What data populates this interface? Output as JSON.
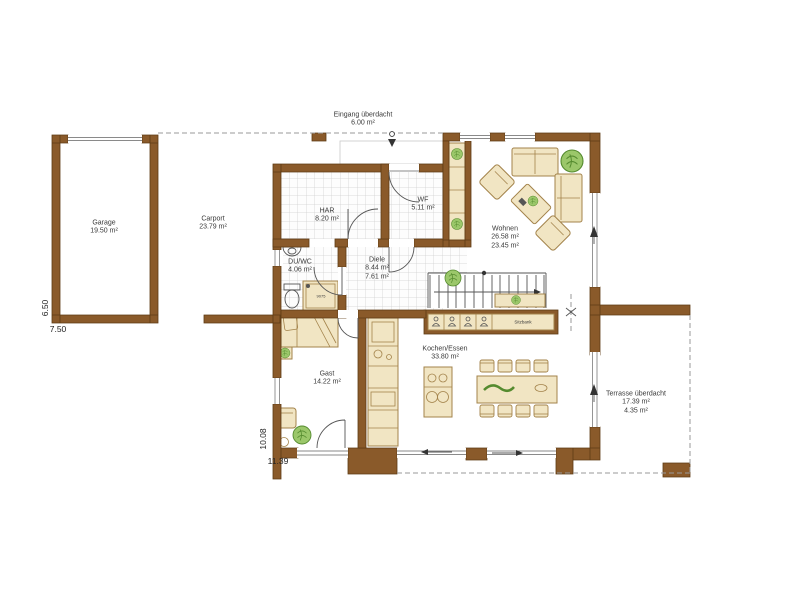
{
  "rooms": {
    "eingang": {
      "name": "Eingang überdacht",
      "area": "6.00 m²"
    },
    "garage": {
      "name": "Garage",
      "area": "19.50 m²"
    },
    "carport": {
      "name": "Carport",
      "area": "23.79 m²"
    },
    "har": {
      "name": "HAR",
      "area": "8.20 m²"
    },
    "wf": {
      "name": "WF",
      "area": "5.11 m²"
    },
    "duwc": {
      "name": "DU/WC",
      "area": "4.06 m²"
    },
    "diele": {
      "name": "Diele",
      "area": "8.44 m²",
      "area2": "7.61 m²"
    },
    "wohnen": {
      "name": "Wohnen",
      "area": "26.58 m²",
      "area2": "23.45 m²"
    },
    "kochen": {
      "name": "Kochen/Essen",
      "area": "33.80 m²"
    },
    "gast": {
      "name": "Gast",
      "area": "14.22 m²"
    },
    "terrasse": {
      "name": "Terrasse überdacht",
      "area": "17.39 m²",
      "area2": "4.35 m²"
    }
  },
  "fixtures": {
    "bench_label": "Sitzbank",
    "shower_label": "9075"
  },
  "dimensions": {
    "garage_height": "6.50",
    "garage_width": "7.50",
    "house_height": "10.08",
    "house_width": "11.39"
  },
  "colors": {
    "wall": "#8a5a2a",
    "wall_stroke": "#5e3b14",
    "furniture": "#f1e5c3",
    "furniture_border": "#a3834b",
    "tile_line": "#cfcfcf",
    "floor": "#ffffff",
    "plant": "#9bc76a",
    "plant_stroke": "#558b2f",
    "line": "#555555",
    "dash": "#999999",
    "text": "#3a3a3a"
  }
}
